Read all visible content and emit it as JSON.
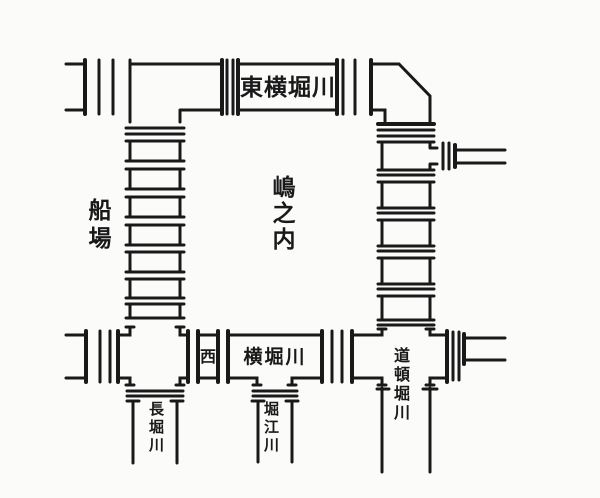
{
  "figure": {
    "districts": [
      {
        "id": "senba",
        "label": "船場"
      },
      {
        "id": "shimanouchi",
        "label": "嶋之内"
      }
    ],
    "canal_labels": [
      {
        "id": "higashi-yokobori",
        "label": "東横堀川",
        "boxed": true
      },
      {
        "id": "nishi",
        "label": "西",
        "boxed": true
      },
      {
        "id": "yokobori",
        "label": "横堀川",
        "boxed": true
      },
      {
        "id": "nagahori",
        "label": "長堀川",
        "boxed": false
      },
      {
        "id": "horie",
        "label": "堀江川",
        "boxed": false
      },
      {
        "id": "dotonbori",
        "label": "道頓堀川",
        "boxed": false
      }
    ],
    "colors": {
      "ink": "#191919",
      "paper": "#fbfbfa"
    }
  }
}
